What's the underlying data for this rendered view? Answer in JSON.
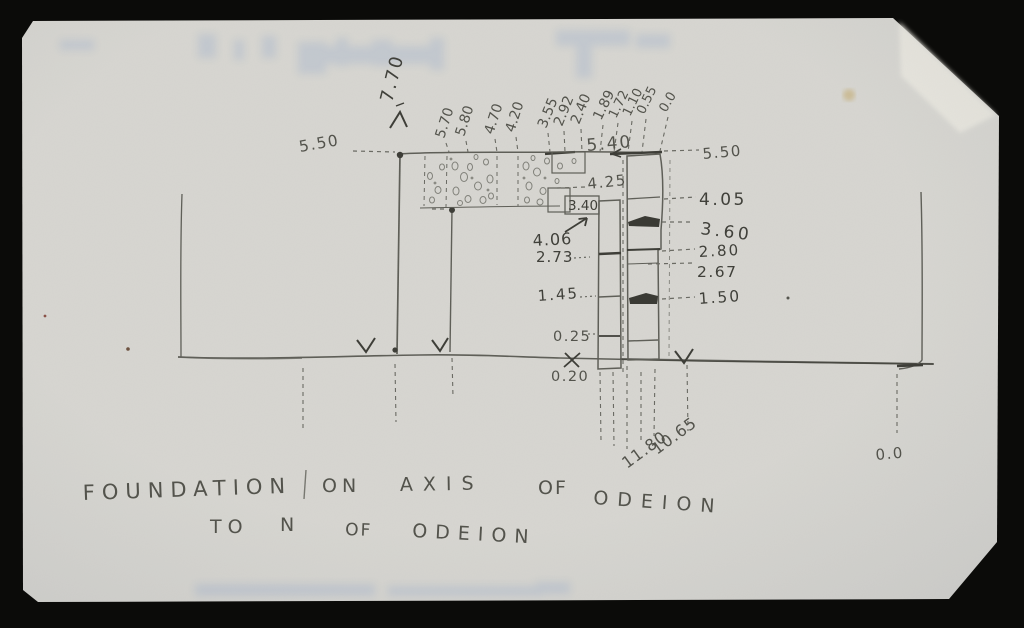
{
  "figure": {
    "kind": "hand-drawn pencil elevation sketch of excavation foundations",
    "paper_color": "#d7d6d1",
    "pencil_color": "#5f5f58",
    "pencil_dark_color": "#3e3e38",
    "background_color": "#0b0b09"
  },
  "labels": {
    "top_row": [
      "7.70",
      "5.70",
      "5.80",
      "4.70",
      "4.20",
      "3.55",
      "2.92",
      "2.40",
      "1.89",
      "1.72",
      "1.10",
      "0.55",
      "0.0"
    ],
    "left_level": "5.50",
    "right_levels": [
      "5.50",
      "4.05",
      "3.60",
      "2.80",
      "2.67",
      "1.50"
    ],
    "mid_levels": [
      "5.40",
      "4.25",
      "3.40",
      "4.06",
      "2.73",
      "1.45",
      "0.25",
      "0.20"
    ],
    "bottom_depths": [
      "11.80",
      "10.65"
    ],
    "datum": "0.0"
  },
  "caption": {
    "line1": [
      "FOUNDATION",
      "ON",
      "AXIS",
      "OF",
      "ODEION"
    ],
    "line2": [
      "TO",
      "N",
      "OF",
      "ODEION"
    ]
  }
}
